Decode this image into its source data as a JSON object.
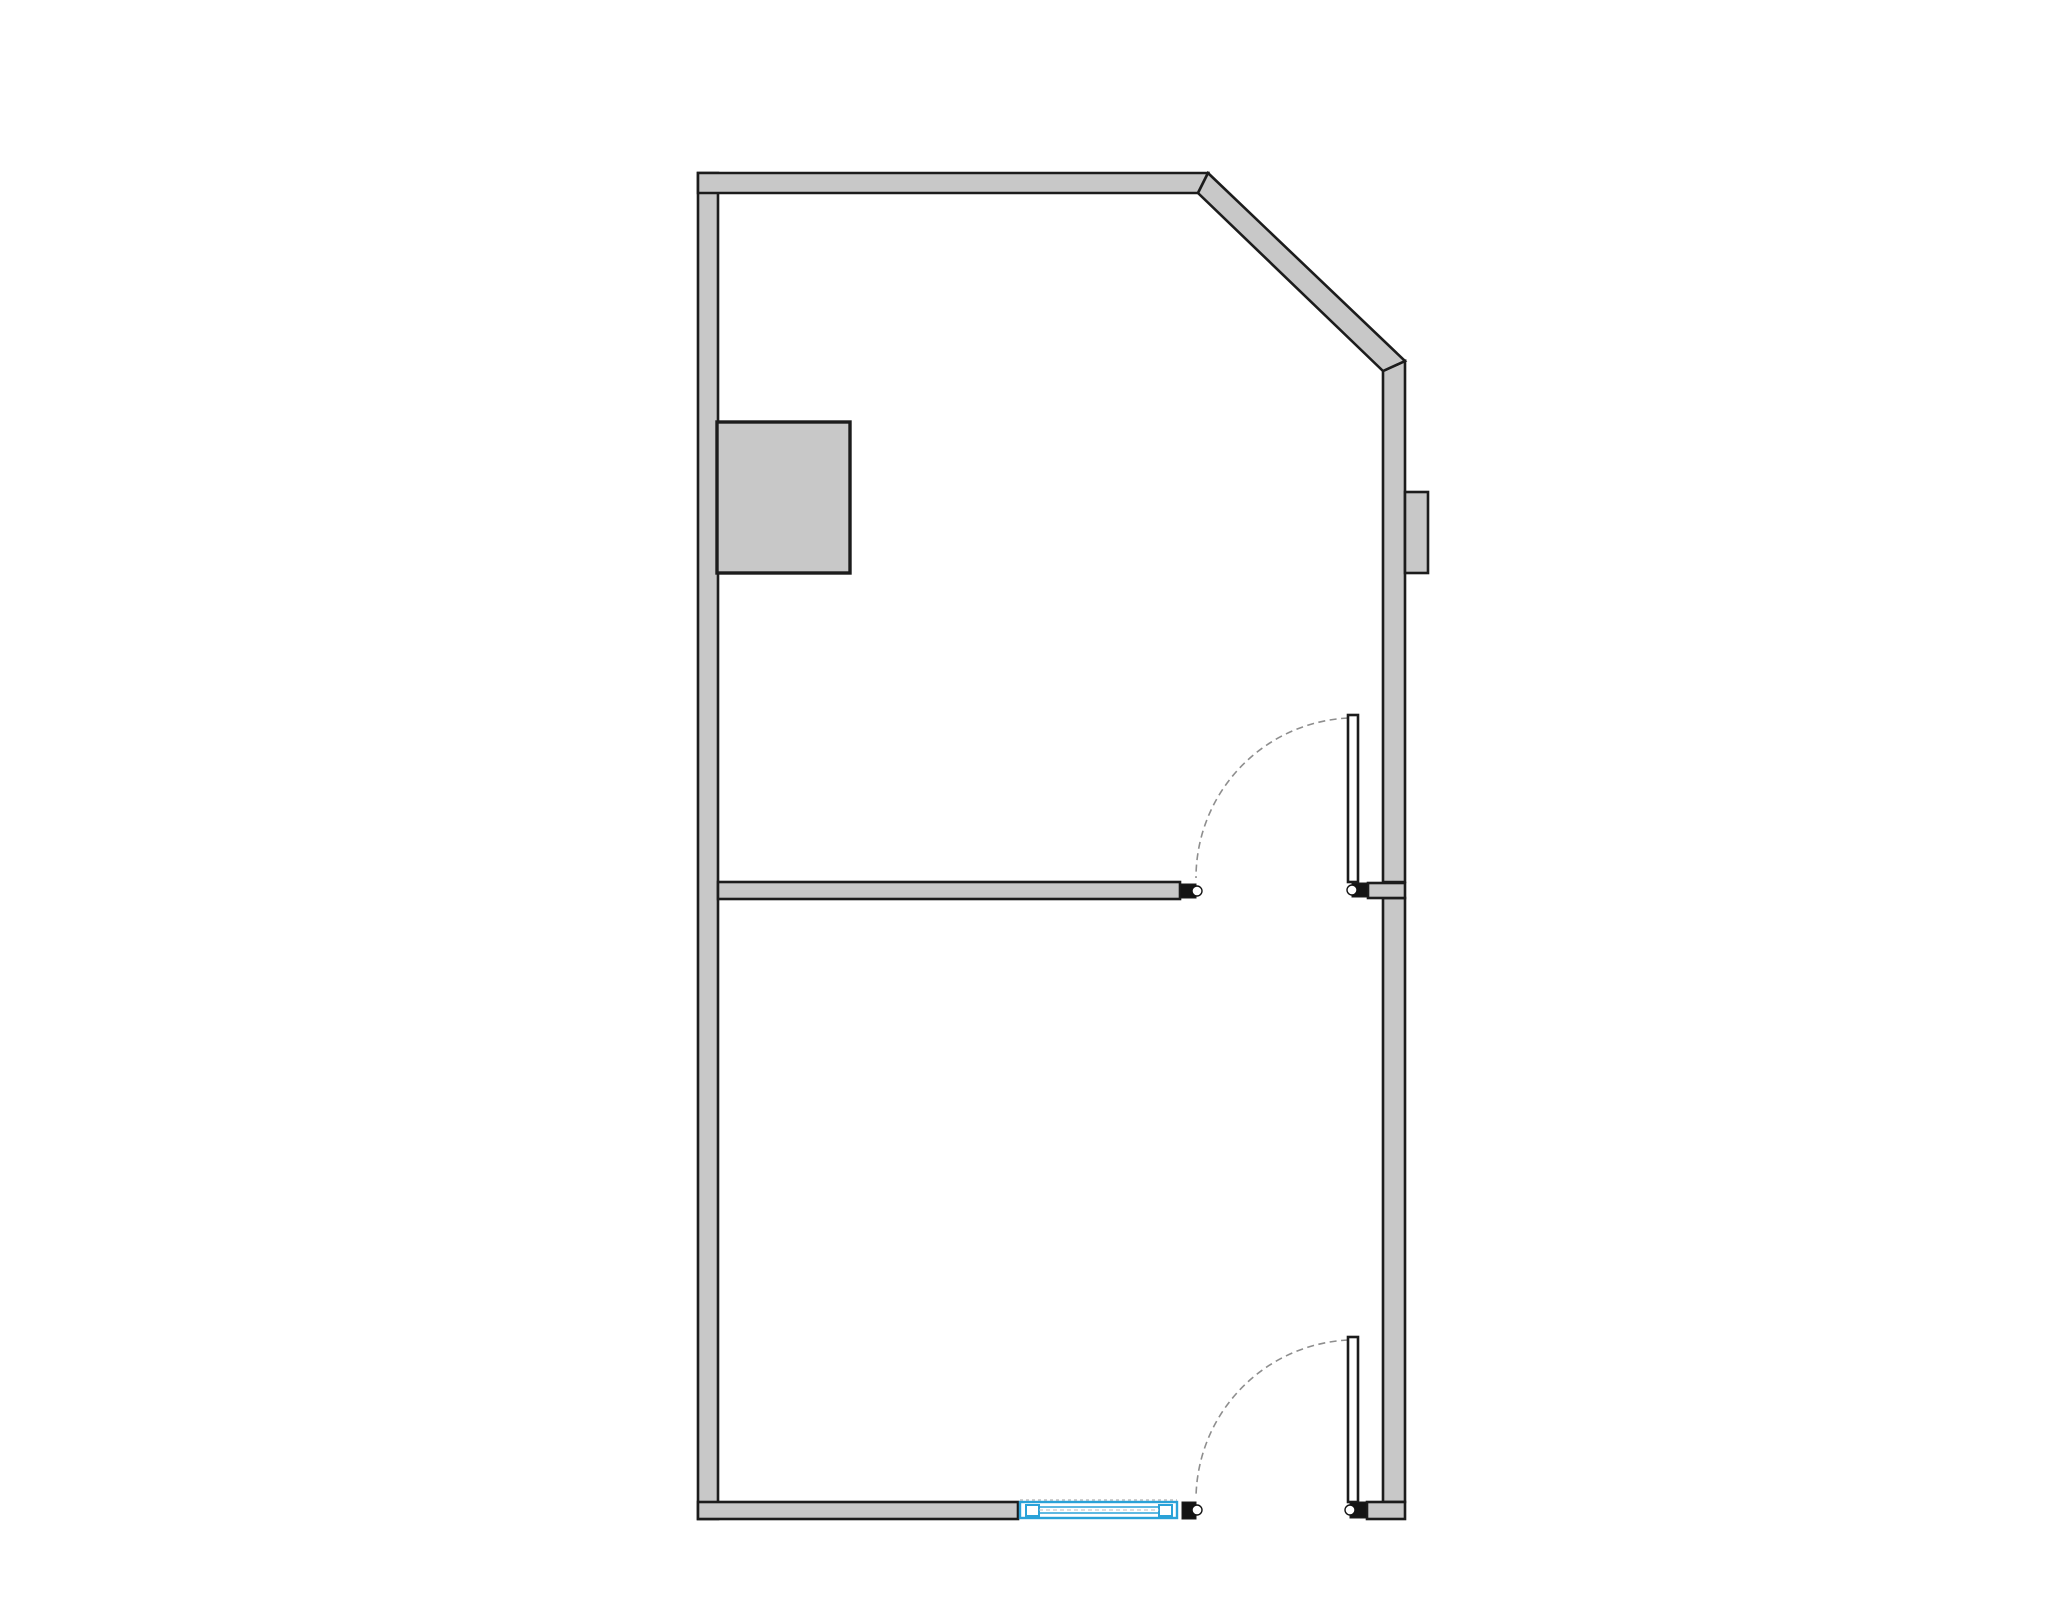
{
  "canvas": {
    "width": 2048,
    "height": 1624,
    "background": "#ffffff"
  },
  "colors": {
    "wall_fill": "#c8c8c8",
    "wall_edge": "#1c1c1c",
    "leaf_fill": "#ffffff",
    "arc_stroke": "#8e8e8e",
    "window_blue": "#2aa2d8",
    "stop_fill": "#141414",
    "notch_fill": "#ffffff",
    "faint_line": "#bdbdbd"
  },
  "floor_plan": {
    "shapes": [
      {
        "name": "left-wall-exterior",
        "type": "rect",
        "x": 698,
        "y": 173,
        "w": 20,
        "h": 1346,
        "fill": "wall_fill",
        "stroke": "wall_edge",
        "sw": 2.6
      },
      {
        "name": "right-wall-upper-exterior",
        "type": "polygon",
        "points": "1383,371 1405,361 1405,882 1383,882",
        "fill": "wall_fill",
        "stroke": "wall_edge",
        "sw": 2.6
      },
      {
        "name": "right-wall-lower-exterior",
        "type": "rect",
        "x": 1383,
        "y": 898,
        "w": 22,
        "h": 604,
        "fill": "wall_fill",
        "stroke": "wall_edge",
        "sw": 2.6
      },
      {
        "name": "top-wall-exterior",
        "type": "polygon",
        "points": "698,173 1208,173 1198,193 698,193",
        "fill": "wall_fill",
        "stroke": "wall_edge",
        "sw": 2.6
      },
      {
        "name": "diagonal-wall-exterior",
        "type": "polygon",
        "points": "1208,173 1405,361 1383,371 1198,193",
        "fill": "wall_fill",
        "stroke": "wall_edge",
        "sw": 2.6
      },
      {
        "name": "bottom-wall-left-exterior",
        "type": "rect",
        "x": 698,
        "y": 1502,
        "w": 320,
        "h": 17,
        "fill": "wall_fill",
        "stroke": "wall_edge",
        "sw": 2.6
      },
      {
        "name": "bottom-right-corner-wall",
        "type": "rect",
        "x": 1367,
        "y": 1502,
        "w": 38,
        "h": 17,
        "fill": "wall_fill",
        "stroke": "wall_edge",
        "sw": 2.6
      },
      {
        "name": "divider-junction-stub",
        "type": "rect",
        "x": 1368,
        "y": 883,
        "w": 37,
        "h": 15,
        "fill": "wall_fill",
        "stroke": "wall_edge",
        "sw": 2.6
      },
      {
        "name": "interior-divider-wall",
        "type": "rect",
        "x": 718,
        "y": 882,
        "w": 462,
        "h": 17,
        "fill": "wall_fill",
        "stroke": "wall_edge",
        "sw": 2.6
      },
      {
        "name": "closet-fixture-block",
        "type": "rect",
        "x": 717,
        "y": 422,
        "w": 133,
        "h": 151,
        "fill": "wall_fill",
        "stroke": "wall_edge",
        "sw": 3.4
      },
      {
        "name": "right-wall-protrusion",
        "type": "rect",
        "x": 1405,
        "y": 492,
        "w": 23,
        "h": 81,
        "fill": "wall_fill",
        "stroke": "wall_edge",
        "sw": 2.6
      },
      {
        "name": "middle-door-swing-arc",
        "type": "path",
        "d": "M 1348 718 A 160 160 0 0 0 1196 878",
        "fill": "none",
        "stroke": "arc_stroke",
        "sw": 1.6,
        "dash": "7 4.5"
      },
      {
        "name": "middle-door-leaf",
        "type": "rect",
        "x": 1348,
        "y": 715,
        "w": 10,
        "h": 167,
        "fill": "leaf_fill",
        "stroke": "wall_edge",
        "sw": 2.6
      },
      {
        "name": "middle-door-jamb-stop",
        "type": "rect",
        "x": 1180,
        "y": 884,
        "w": 16,
        "h": 14,
        "fill": "stop_fill",
        "stroke": "wall_edge",
        "sw": 1
      },
      {
        "name": "middle-door-jamb-notch",
        "type": "circle",
        "cx": 1197,
        "cy": 891,
        "r": 5,
        "fill": "notch_fill",
        "stroke": "stop_fill",
        "sw": 1.4
      },
      {
        "name": "middle-door-hinge-stop",
        "type": "rect",
        "x": 1352,
        "y": 883,
        "w": 16,
        "h": 14,
        "fill": "stop_fill",
        "stroke": "wall_edge",
        "sw": 1
      },
      {
        "name": "middle-door-hinge-notch",
        "type": "circle",
        "cx": 1352,
        "cy": 890,
        "r": 5,
        "fill": "notch_fill",
        "stroke": "stop_fill",
        "sw": 1.4
      },
      {
        "name": "bottom-door-swing-arc",
        "type": "path",
        "d": "M 1348 1340 A 160 160 0 0 0 1196 1498",
        "fill": "none",
        "stroke": "arc_stroke",
        "sw": 1.6,
        "dash": "7 4.5"
      },
      {
        "name": "bottom-door-leaf",
        "type": "rect",
        "x": 1348,
        "y": 1337,
        "w": 10,
        "h": 165,
        "fill": "leaf_fill",
        "stroke": "wall_edge",
        "sw": 2.6
      },
      {
        "name": "bottom-door-jamb-stop",
        "type": "rect",
        "x": 1182,
        "y": 1502,
        "w": 14,
        "h": 17,
        "fill": "stop_fill",
        "stroke": "wall_edge",
        "sw": 1
      },
      {
        "name": "bottom-door-jamb-notch",
        "type": "circle",
        "cx": 1197,
        "cy": 1510,
        "r": 5,
        "fill": "notch_fill",
        "stroke": "stop_fill",
        "sw": 1.4
      },
      {
        "name": "bottom-door-hinge-stop",
        "type": "rect",
        "x": 1350,
        "y": 1502,
        "w": 17,
        "h": 16,
        "fill": "stop_fill",
        "stroke": "wall_edge",
        "sw": 1
      },
      {
        "name": "bottom-door-hinge-notch",
        "type": "circle",
        "cx": 1350,
        "cy": 1510,
        "r": 5,
        "fill": "notch_fill",
        "stroke": "stop_fill",
        "sw": 1.4
      },
      {
        "name": "window-head-line",
        "type": "line",
        "x1": 1020,
        "y1": 1500,
        "x2": 1177,
        "y2": 1500,
        "fill": "none",
        "stroke": "faint_line",
        "sw": 1.4,
        "dash": "3 3"
      },
      {
        "name": "window-frame",
        "type": "rect",
        "x": 1020,
        "y": 1502,
        "w": 157,
        "h": 16,
        "fill": "leaf_fill",
        "stroke": "window_blue",
        "sw": 2.4
      },
      {
        "name": "window-pane-left",
        "type": "rect",
        "x": 1026,
        "y": 1505,
        "w": 13,
        "h": 11,
        "fill": "leaf_fill",
        "stroke": "window_blue",
        "sw": 2
      },
      {
        "name": "window-pane-right",
        "type": "rect",
        "x": 1159,
        "y": 1505,
        "w": 13,
        "h": 11,
        "fill": "leaf_fill",
        "stroke": "window_blue",
        "sw": 2
      },
      {
        "name": "window-glass-upper-line",
        "type": "line",
        "x1": 1039,
        "y1": 1507,
        "x2": 1159,
        "y2": 1507,
        "fill": "none",
        "stroke": "window_blue",
        "sw": 1.4
      },
      {
        "name": "window-glass-lower-line",
        "type": "line",
        "x1": 1039,
        "y1": 1513,
        "x2": 1159,
        "y2": 1513,
        "fill": "none",
        "stroke": "window_blue",
        "sw": 1.4
      },
      {
        "name": "window-glass-dash-line",
        "type": "line",
        "x1": 1039,
        "y1": 1510,
        "x2": 1159,
        "y2": 1510,
        "fill": "none",
        "stroke": "faint_line",
        "sw": 1,
        "dash": "4 3"
      }
    ]
  }
}
